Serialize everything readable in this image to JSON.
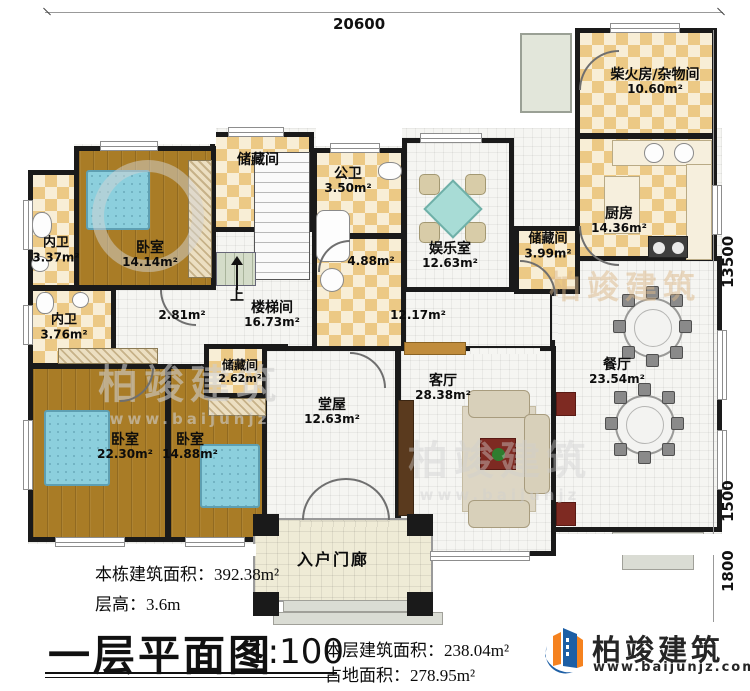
{
  "plan": {
    "rooms": {
      "chaihuofang": {
        "name": "柴火房/杂物间",
        "area": "10.60m²"
      },
      "chufang": {
        "name": "厨房",
        "area": "14.36m²"
      },
      "chucang_right": {
        "name": "储藏间",
        "area": "3.99m²"
      },
      "canting": {
        "name": "餐厅",
        "area": "23.54m²"
      },
      "yuleshi": {
        "name": "娱乐室",
        "area": "12.63m²"
      },
      "gongwei": {
        "name": "公卫",
        "area": "3.50m²"
      },
      "bath": {
        "area": "4.88m²"
      },
      "chucang_top": {
        "name": "储藏间"
      },
      "loutijian": {
        "name": "楼梯间",
        "area": "16.73m²"
      },
      "stair_up": "上",
      "stair_side_area": "2.81m²",
      "corridor_area": "12.17m²",
      "woshi1": {
        "name": "卧室",
        "area": "14.14m²"
      },
      "neiwei1": {
        "name": "内卫",
        "area": "3.37m²"
      },
      "neiwei2": {
        "name": "内卫",
        "area": "3.76m²"
      },
      "woshi2": {
        "name": "卧室",
        "area": "22.30m²"
      },
      "woshi3": {
        "name": "卧室",
        "area": "14.88m²"
      },
      "chucang_small": {
        "name": "储藏间",
        "area": "2.62m²"
      },
      "tangwu": {
        "name": "堂屋",
        "area": "12.63m²"
      },
      "keting": {
        "name": "客厅",
        "area": "28.38m²"
      },
      "porch": {
        "name": "入户门廊"
      }
    },
    "dimensions": {
      "top": "20600",
      "right": "13500",
      "right_lower": "1500",
      "right_bottom": "1800"
    }
  },
  "footer": {
    "building_total_label": "本栋建筑面积：",
    "building_total_value": "392.38m²",
    "floor_height_label": "层高：",
    "floor_height_value": "3.6m",
    "title": "一层平面图",
    "scale": "1:100",
    "floor_area_label": "本层建筑面积：",
    "floor_area_value": "238.04m²",
    "footprint_label": "占地面积：",
    "footprint_value": "278.95m²"
  },
  "logo": {
    "name": "柏竣建筑",
    "site": "www.baijunjz.com"
  },
  "watermark": {
    "text": "柏竣建筑",
    "site": "www.baijunjz"
  },
  "colors": {
    "wall": "#1a1a1a",
    "wood": "#a97c26",
    "check_dark": "#ecc985",
    "check_light": "#f8eed6",
    "tile": "#f5f5f2",
    "bed": "#8ccfdd",
    "logo_orange": "#f5821f",
    "logo_blue": "#1d5fa5"
  }
}
